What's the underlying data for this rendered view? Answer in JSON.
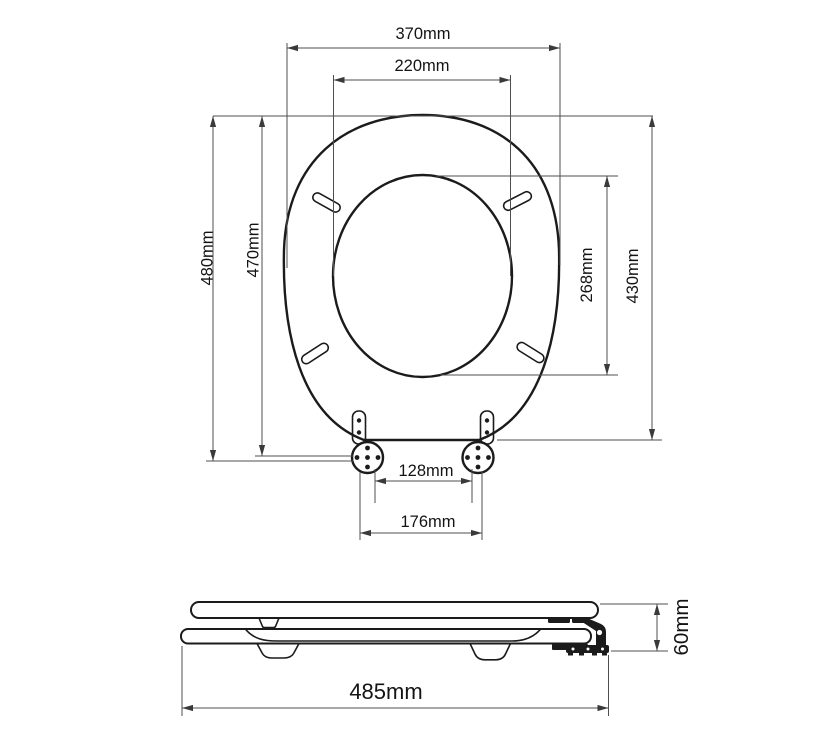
{
  "diagram_subject": "toilet-seat-technical-drawing",
  "colors": {
    "outline": "#1b1b1b",
    "dimension_lines": "#4f4f4f",
    "background": "#ffffff"
  },
  "dimensions": {
    "outer_width": "370mm",
    "inner_width": "220mm",
    "overall_length": "480mm",
    "seat_length": "470mm",
    "inner_length": "268mm",
    "outer_length": "430mm",
    "hinge_inner_spacing": "128mm",
    "hinge_outer_spacing": "176mm",
    "side_length": "485mm",
    "side_height": "60mm"
  }
}
